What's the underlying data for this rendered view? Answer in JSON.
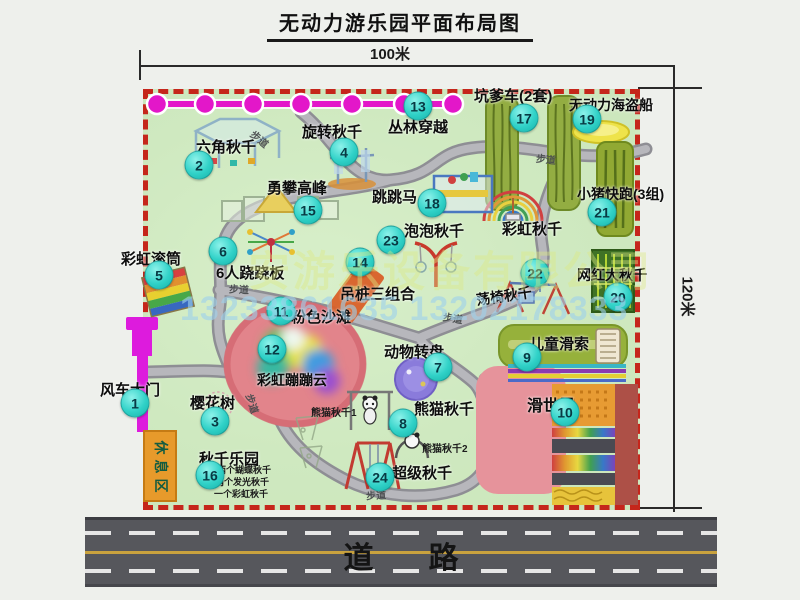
{
  "title": "无动力游乐园平面布局图",
  "dimensions": {
    "top": "100米",
    "right": "120米"
  },
  "road": {
    "label": "道路"
  },
  "watermark": {
    "company": "安游乐设备有限公司",
    "phone": "13233861635 13202178333"
  },
  "park": {
    "rest_area_label": "休息区",
    "walkway_text": "步道",
    "walkways": [
      {
        "x": 250,
        "y": 131,
        "rot": 40
      },
      {
        "x": 536,
        "y": 151,
        "rot": 6
      },
      {
        "x": 229,
        "y": 281,
        "rot": 3
      },
      {
        "x": 443,
        "y": 310,
        "rot": 10
      },
      {
        "x": 243,
        "y": 396,
        "rot": 72
      },
      {
        "x": 366,
        "y": 487,
        "rot": -3
      }
    ],
    "attractions": [
      {
        "num": "1",
        "name": "风车大门",
        "bx": 135,
        "by": 403,
        "lx": 100,
        "ly": 379,
        "fs": 15
      },
      {
        "num": "2",
        "name": "六角秋千",
        "bx": 199,
        "by": 165,
        "lx": 196,
        "ly": 136,
        "fs": 15
      },
      {
        "num": "3",
        "name": "樱花树",
        "bx": 215,
        "by": 421,
        "lx": 190,
        "ly": 392,
        "fs": 15
      },
      {
        "num": "4",
        "name": "旋转秋千",
        "bx": 344,
        "by": 152,
        "lx": 302,
        "ly": 121,
        "fs": 15
      },
      {
        "num": "5",
        "name": "彩虹滚筒",
        "bx": 159,
        "by": 275,
        "lx": 121,
        "ly": 248,
        "fs": 15
      },
      {
        "num": "6",
        "name": "6人跷跷板",
        "bx": 223,
        "by": 251,
        "lx": 216,
        "ly": 262,
        "fs": 15
      },
      {
        "num": "7",
        "name": "动物转盘",
        "bx": 438,
        "by": 367,
        "lx": 384,
        "ly": 341,
        "fs": 15
      },
      {
        "num": "8",
        "name": "熊猫秋千",
        "bx": 403,
        "by": 423,
        "lx": 414,
        "ly": 398,
        "fs": 15
      },
      {
        "num": "9",
        "name": "儿童滑索",
        "bx": 527,
        "by": 357,
        "lx": 529,
        "ly": 333,
        "fs": 15
      },
      {
        "num": "10",
        "name": "滑世界",
        "bx": 565,
        "by": 412,
        "lx": 527,
        "ly": 392,
        "fs": 16
      },
      {
        "num": "11",
        "name": "粉色沙滩",
        "bx": 281,
        "by": 311,
        "lx": 291,
        "ly": 306,
        "fs": 15
      },
      {
        "num": "12",
        "name": "彩虹蹦蹦云",
        "bx": 272,
        "by": 349,
        "lx": 257,
        "ly": 370,
        "fs": 14
      },
      {
        "num": "13",
        "name": "丛林穿越",
        "bx": 418,
        "by": 106,
        "lx": 388,
        "ly": 116,
        "fs": 15
      },
      {
        "num": "14",
        "name": "吊桩三组合",
        "bx": 360,
        "by": 262,
        "lx": 340,
        "ly": 283,
        "fs": 15
      },
      {
        "num": "15",
        "name": "勇攀高峰",
        "bx": 308,
        "by": 210,
        "lx": 267,
        "ly": 177,
        "fs": 15
      },
      {
        "num": "16",
        "name": "秋千乐园",
        "bx": 210,
        "by": 475,
        "lx": 199,
        "ly": 448,
        "fs": 15
      },
      {
        "num": "17",
        "name": "坑爹车(2套)",
        "bx": 524,
        "by": 118,
        "lx": 474,
        "ly": 85,
        "fs": 15
      },
      {
        "num": "18",
        "name": "跳跳马",
        "bx": 432,
        "by": 203,
        "lx": 372,
        "ly": 186,
        "fs": 15
      },
      {
        "num": "19",
        "name": "无动力海盗船",
        "bx": 587,
        "by": 119,
        "lx": 569,
        "ly": 95,
        "fs": 14
      },
      {
        "num": "20",
        "name": "网红大秋千",
        "bx": 618,
        "by": 297,
        "lx": 577,
        "ly": 265,
        "fs": 14
      },
      {
        "num": "21",
        "name": "小猪快跑(3组)",
        "bx": 602,
        "by": 212,
        "lx": 577,
        "ly": 184,
        "fs": 14
      },
      {
        "num": "22",
        "name": "荡椅秋千",
        "bx": 535,
        "by": 273,
        "lx": 476,
        "ly": 286,
        "fs": 14,
        "rot": -8
      },
      {
        "num": "23",
        "name": "泡泡秋千",
        "bx": 391,
        "by": 240,
        "lx": 404,
        "ly": 220,
        "fs": 15
      },
      {
        "num": "24",
        "name": "超级秋千",
        "bx": 380,
        "by": 477,
        "lx": 392,
        "ly": 462,
        "fs": 15
      },
      {
        "num": "",
        "name": "彩虹秋千",
        "bx": 0,
        "by": 0,
        "lx": 502,
        "ly": 218,
        "fs": 15
      }
    ],
    "sublabels": [
      {
        "text": "熊猫秋千1",
        "x": 311,
        "y": 404,
        "fs": 10
      },
      {
        "text": "熊猫秋千2",
        "x": 422,
        "y": 440,
        "fs": 10
      },
      {
        "text": "两个蝴蝶秋千",
        "x": 217,
        "y": 463,
        "fs": 9
      },
      {
        "text": "两个发光秋千",
        "x": 215,
        "y": 475,
        "fs": 9
      },
      {
        "text": "一个彩虹秋千",
        "x": 214,
        "y": 487,
        "fs": 9
      }
    ]
  },
  "colors": {
    "badge": "#2fd0c8",
    "border_dashed": "#c5261b",
    "park_green": "#cfe9c0",
    "chain_magenta": "#e317c9",
    "road_gray": "#56575c",
    "gate_magenta": "#dd1bdd",
    "rest_area_orange": "#e79a2b"
  }
}
